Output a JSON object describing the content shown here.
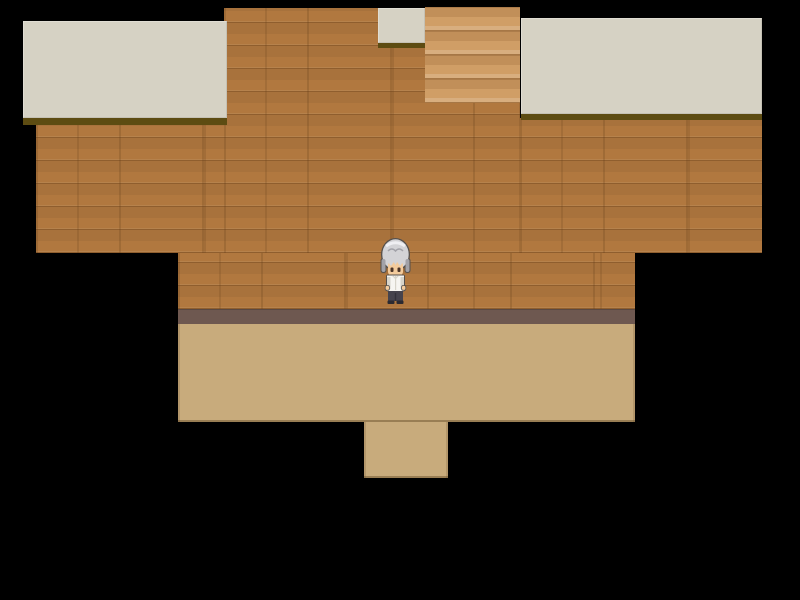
{
  "scene": {
    "viewport": {
      "width": 800,
      "height": 600,
      "background": "#000000"
    },
    "colors": {
      "wood": "#b1783f",
      "ceiling": "#d6d2c4",
      "ceiling_shadow": "#5d4c12",
      "siding": "#cf9c63",
      "baseboard": "#6e5850",
      "floor": "#c8ab7c",
      "black": "#000000"
    },
    "regions": [
      {
        "name": "wood-wall-center",
        "type": "wood",
        "color": "wood",
        "x": 224,
        "y": 8,
        "w": 296,
        "h": 245,
        "interactable": false
      },
      {
        "name": "wood-wall-left",
        "type": "wood",
        "color": "wood",
        "x": 36,
        "y": 125,
        "w": 188,
        "h": 128,
        "interactable": false
      },
      {
        "name": "wood-wall-right",
        "type": "wood",
        "color": "wood",
        "x": 520,
        "y": 118,
        "w": 242,
        "h": 135,
        "interactable": false
      },
      {
        "name": "wood-wall-lower",
        "type": "wood",
        "color": "wood",
        "x": 178,
        "y": 253,
        "w": 457,
        "h": 56,
        "interactable": false
      },
      {
        "name": "baseboard",
        "type": "baseboard",
        "color": "baseboard",
        "x": 178,
        "y": 309,
        "w": 457,
        "h": 15,
        "interactable": false
      },
      {
        "name": "floor-main",
        "type": "floor",
        "color": "floor",
        "x": 178,
        "y": 324,
        "w": 457,
        "h": 98,
        "interactable": true
      },
      {
        "name": "floor-doorway",
        "type": "floor",
        "color": "floor",
        "x": 364,
        "y": 422,
        "w": 84,
        "h": 56,
        "interactable": true
      },
      {
        "name": "exit-siding-tile",
        "type": "siding",
        "color": "siding",
        "x": 425,
        "y": 7,
        "w": 95,
        "h": 96,
        "interactable": false
      },
      {
        "name": "ceiling-tile-top",
        "type": "ceiling",
        "color": "ceiling",
        "x": 378,
        "y": 8,
        "w": 47,
        "h": 35,
        "interactable": false
      },
      {
        "name": "ceiling-shadow-top",
        "type": "shadow",
        "color": "ceiling_shadow",
        "x": 378,
        "y": 43,
        "w": 47,
        "h": 5,
        "interactable": false
      },
      {
        "name": "ceiling-tile-left",
        "type": "ceiling",
        "color": "ceiling",
        "x": 23,
        "y": 21,
        "w": 204,
        "h": 97,
        "interactable": false
      },
      {
        "name": "ceiling-shadow-left",
        "type": "shadow",
        "color": "ceiling_shadow",
        "x": 23,
        "y": 118,
        "w": 204,
        "h": 7,
        "interactable": false
      },
      {
        "name": "ceiling-tile-right",
        "type": "ceiling",
        "color": "ceiling",
        "x": 521,
        "y": 18,
        "w": 241,
        "h": 96,
        "interactable": false
      },
      {
        "name": "ceiling-shadow-right",
        "type": "shadow",
        "color": "ceiling_shadow",
        "x": 521,
        "y": 114,
        "w": 241,
        "h": 6,
        "interactable": false
      }
    ],
    "character": {
      "name": "player-character",
      "facing": "down",
      "x": 380,
      "y": 237,
      "width": 31,
      "height": 67,
      "colors": {
        "outline": "#55504c",
        "hair": "#d3d3d6",
        "hair_shadow": "#a2a2a8",
        "hair_highlight": "#efeff2",
        "skin": "#f3cb9c",
        "eye": "#4a3428",
        "shirt": "#f6f5f1",
        "shirt_shadow": "#d7d4ca",
        "pants": "#45434d",
        "pants_shadow": "#32313a",
        "shoes": "#2b2a31"
      }
    }
  }
}
